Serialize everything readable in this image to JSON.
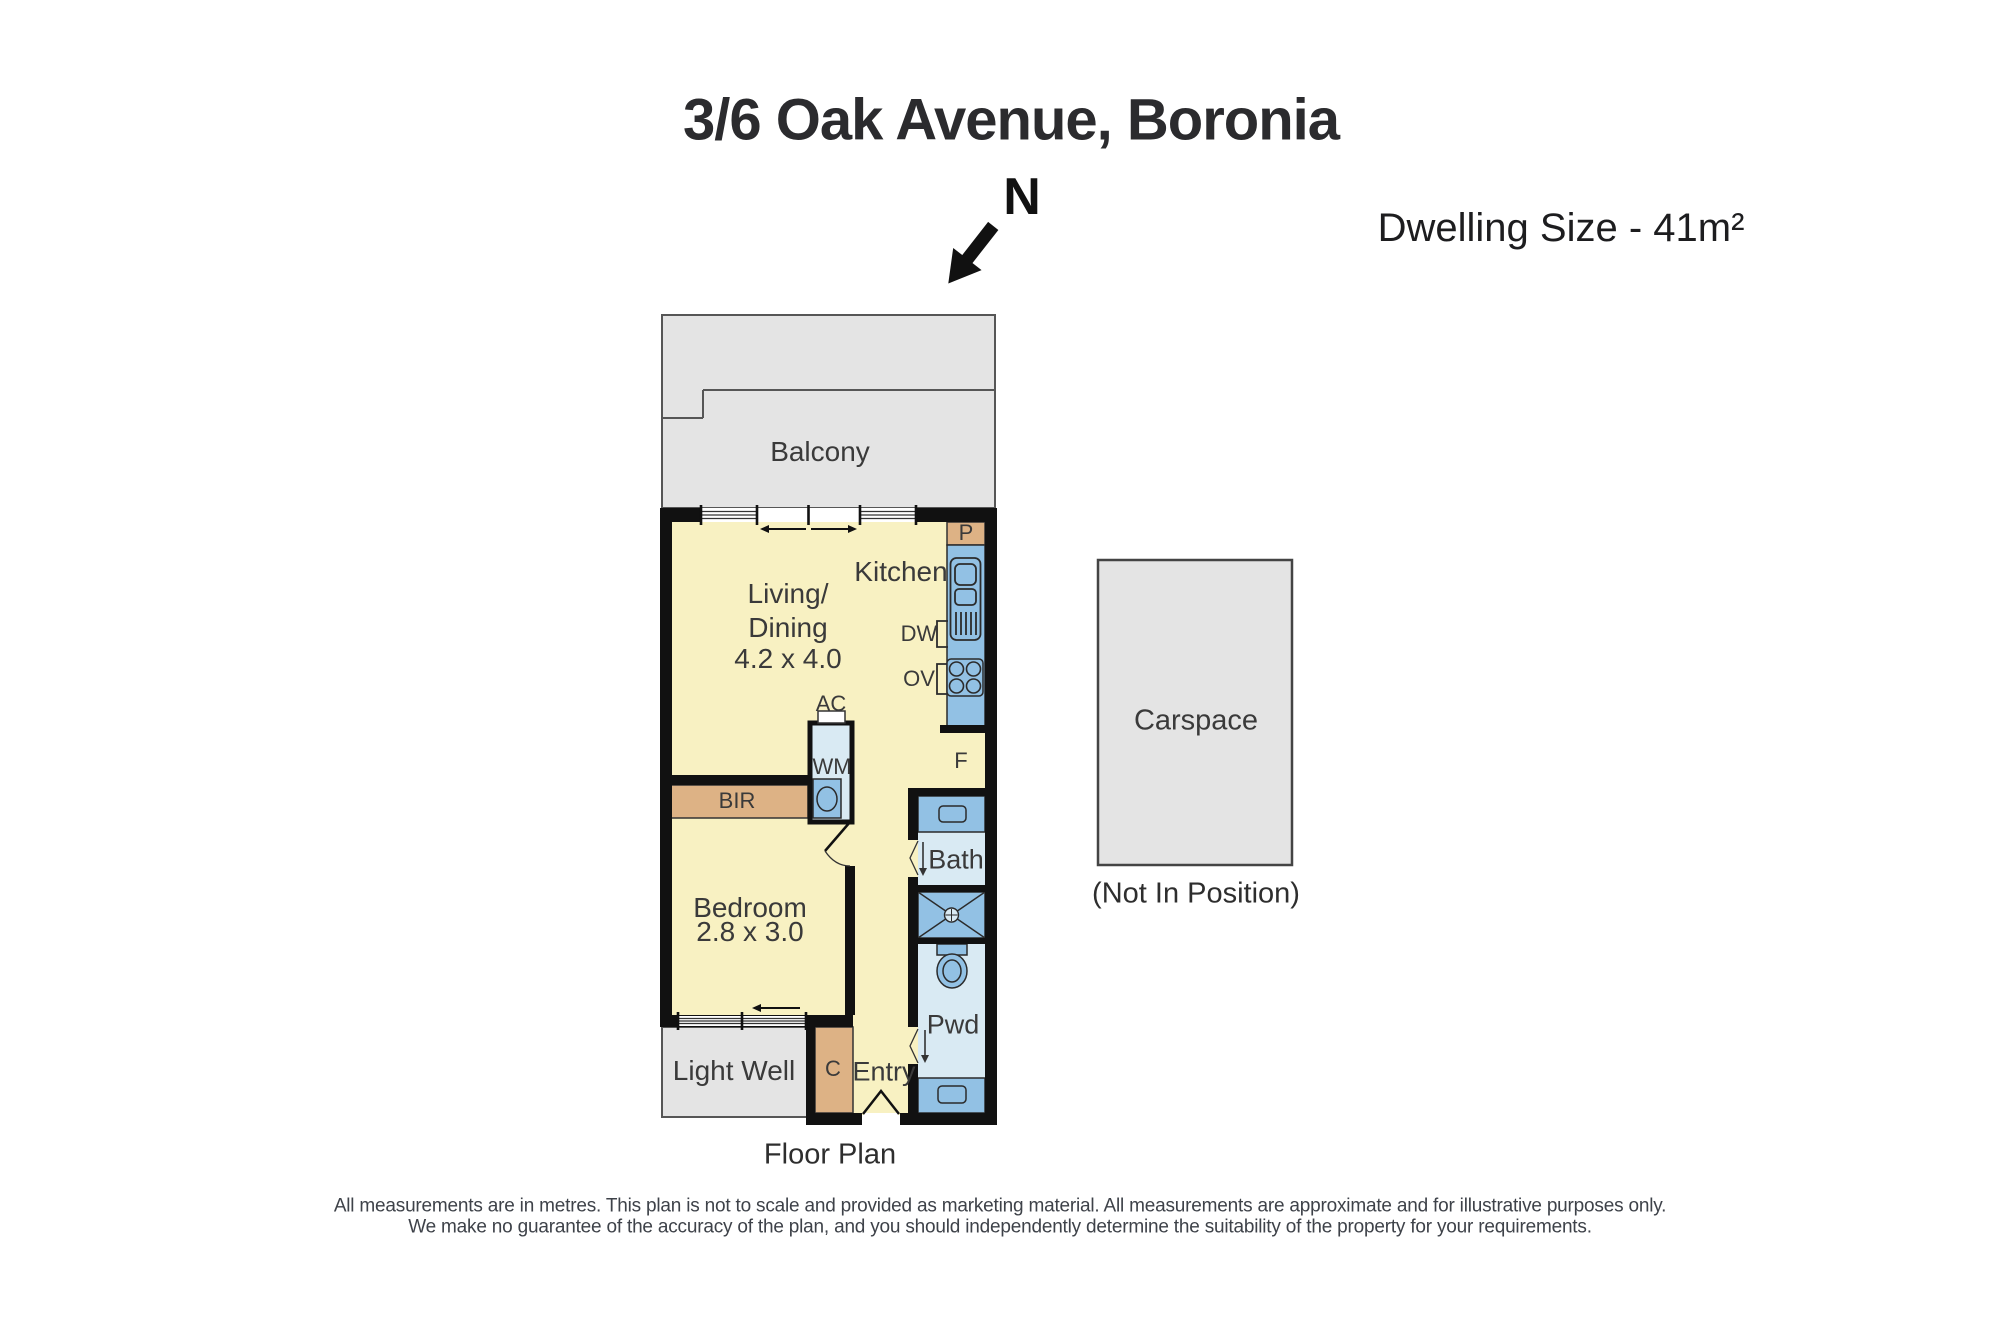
{
  "header": {
    "title": "3/6 Oak Avenue, Boronia",
    "north_label": "N",
    "dwelling_size": "Dwelling Size - 41m²"
  },
  "rooms": {
    "balcony": "Balcony",
    "kitchen": "Kitchen",
    "living_line1": "Living/",
    "living_line2": "Dining",
    "living_dims": "4.2 x 4.0",
    "bedroom": "Bedroom",
    "bedroom_dims": "2.8 x 3.0",
    "bath": "Bath",
    "powder": "Pwd",
    "entry": "Entry",
    "light_well": "Light Well",
    "carspace": "Carspace",
    "carspace_note": "(Not In Position)"
  },
  "fixtures": {
    "pantry": "P",
    "dishwasher": "DW",
    "oven": "OV",
    "fridge": "F",
    "aircon": "AC",
    "washing_machine": "WM",
    "built_in_robe": "BIR",
    "cupboard": "C"
  },
  "footer": {
    "caption": "Floor Plan",
    "disclaimer_line1": "All measurements are in metres. This plan is not to scale and provided as marketing material. All measurements are approximate and for illustrative purposes only.",
    "disclaimer_line2": "We make no guarantee of the accuracy of the plan, and you should independently determine the suitability of the property for your requirements."
  },
  "colors": {
    "room_fill": "#f8f1c2",
    "joinery": "#ddb285",
    "fixture_blue": "#92c1e4",
    "wet_floor": "#d9eaf3",
    "outdoor_gray": "#e4e4e4",
    "wall": "#111111",
    "text": "#3a3a3a"
  }
}
